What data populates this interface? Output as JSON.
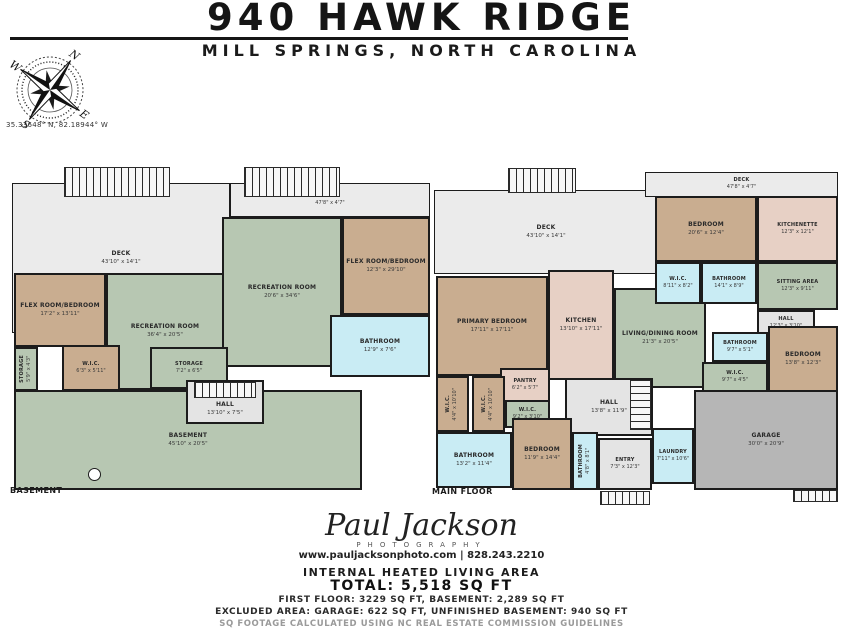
{
  "header": {
    "title": "940 HAWK RIDGE",
    "subtitle": "MILL SPRINGS, NORTH CAROLINA"
  },
  "compass": {
    "n": "N",
    "e": "E",
    "s": "S",
    "w": "W",
    "coordinates": "35.33648° N, 82.18944° W"
  },
  "colors": {
    "deck": "#ebebeb",
    "room_green": "#b7c7b2",
    "room_tan": "#c9ad90",
    "room_blue": "#c9ecf4",
    "room_pink": "#e7d0c5",
    "hall_gray": "#e4e4e4",
    "garage_gray": "#b6b6b6",
    "wall": "#1c1c1c"
  },
  "plans": {
    "basement": {
      "floor_label": "BASEMENT",
      "rooms": [
        {
          "name": "DECK",
          "dims": "43'10\" x 14'1\""
        },
        {
          "name": "DECK",
          "dims": "47'8\" x 4'7\""
        },
        {
          "name": "RECREATION ROOM",
          "dims": "20'6\" x 34'6\""
        },
        {
          "name": "FLEX ROOM/BEDROOM",
          "dims": "12'3\" x 29'10\""
        },
        {
          "name": "FLEX ROOM/BEDROOM",
          "dims": "17'2\" x 13'11\""
        },
        {
          "name": "RECREATION ROOM",
          "dims": "36'4\" x 20'5\""
        },
        {
          "name": "STORAGE",
          "dims": "5'9\" x 4'3\""
        },
        {
          "name": "W.I.C.",
          "dims": "6'3\" x 5'11\""
        },
        {
          "name": "STORAGE",
          "dims": "7'2\" x 6'5\""
        },
        {
          "name": "BATHROOM",
          "dims": "12'9\" x 7'6\""
        },
        {
          "name": "HALL",
          "dims": "13'10\" x 7'5\""
        },
        {
          "name": "BASEMENT",
          "dims": "45'10\" x 20'5\""
        }
      ]
    },
    "main": {
      "floor_label": "MAIN FLOOR",
      "rooms": [
        {
          "name": "DECK",
          "dims": "43'10\" x 14'1\""
        },
        {
          "name": "DECK",
          "dims": "47'8\" x 4'7\""
        },
        {
          "name": "BEDROOM",
          "dims": "20'6\" x 12'4\""
        },
        {
          "name": "KITCHENETTE",
          "dims": "12'3\" x 12'1\""
        },
        {
          "name": "W.I.C.",
          "dims": "8'11\" x 8'2\""
        },
        {
          "name": "BATHROOM",
          "dims": "14'1\" x 8'9\""
        },
        {
          "name": "SITTING AREA",
          "dims": "12'3\" x 9'11\""
        },
        {
          "name": "PRIMARY BEDROOM",
          "dims": "17'11\" x 17'11\""
        },
        {
          "name": "KITCHEN",
          "dims": "13'10\" x 17'11\""
        },
        {
          "name": "LIVING/DINING ROOM",
          "dims": "21'3\" x 20'5\""
        },
        {
          "name": "HALL",
          "dims": "12'3\" x 3'10\""
        },
        {
          "name": "BATHROOM",
          "dims": "9'7\" x 5'1\""
        },
        {
          "name": "BEDROOM",
          "dims": "13'8\" x 12'3\""
        },
        {
          "name": "W.I.C.",
          "dims": "9'7\" x 4'5\""
        },
        {
          "name": "PANTRY",
          "dims": "6'2\" x 5'7\""
        },
        {
          "name": "W.I.C.",
          "dims": "4'4\" x 10'10\""
        },
        {
          "name": "W.I.C.",
          "dims": "4'4\" x 10'10\""
        },
        {
          "name": "W.I.C.",
          "dims": "9'2\" x 3'10\""
        },
        {
          "name": "HALL",
          "dims": "13'8\" x 11'9\""
        },
        {
          "name": "BATHROOM",
          "dims": "13'2\" x 11'4\""
        },
        {
          "name": "BEDROOM",
          "dims": "11'9\" x 14'4\""
        },
        {
          "name": "BATHROOM",
          "dims": "4'8\" x 8'1\""
        },
        {
          "name": "ENTRY",
          "dims": "7'3\" x 12'3\""
        },
        {
          "name": "LAUNDRY",
          "dims": "7'11\" x 10'6\""
        },
        {
          "name": "GARAGE",
          "dims": "30'0\" x 20'9\""
        }
      ]
    }
  },
  "footer": {
    "logo_name": "Paul Jackson",
    "logo_sub": "PHOTOGRAPHY",
    "logo_contact": "www.pauljacksonphoto.com  |  828.243.2210",
    "heading": "INTERNAL HEATED LIVING AREA",
    "total": "TOTAL: 5,518 SQ FT",
    "line1": "FIRST FLOOR: 3229 SQ FT, BASEMENT: 2,289 SQ FT",
    "line2": "EXCLUDED AREA: GARAGE: 622 SQ FT, UNFINISHED BASEMENT: 940 SQ FT",
    "line3": "SQ FOOTAGE CALCULATED USING NC REAL ESTATE COMMISSION GUIDELINES"
  }
}
